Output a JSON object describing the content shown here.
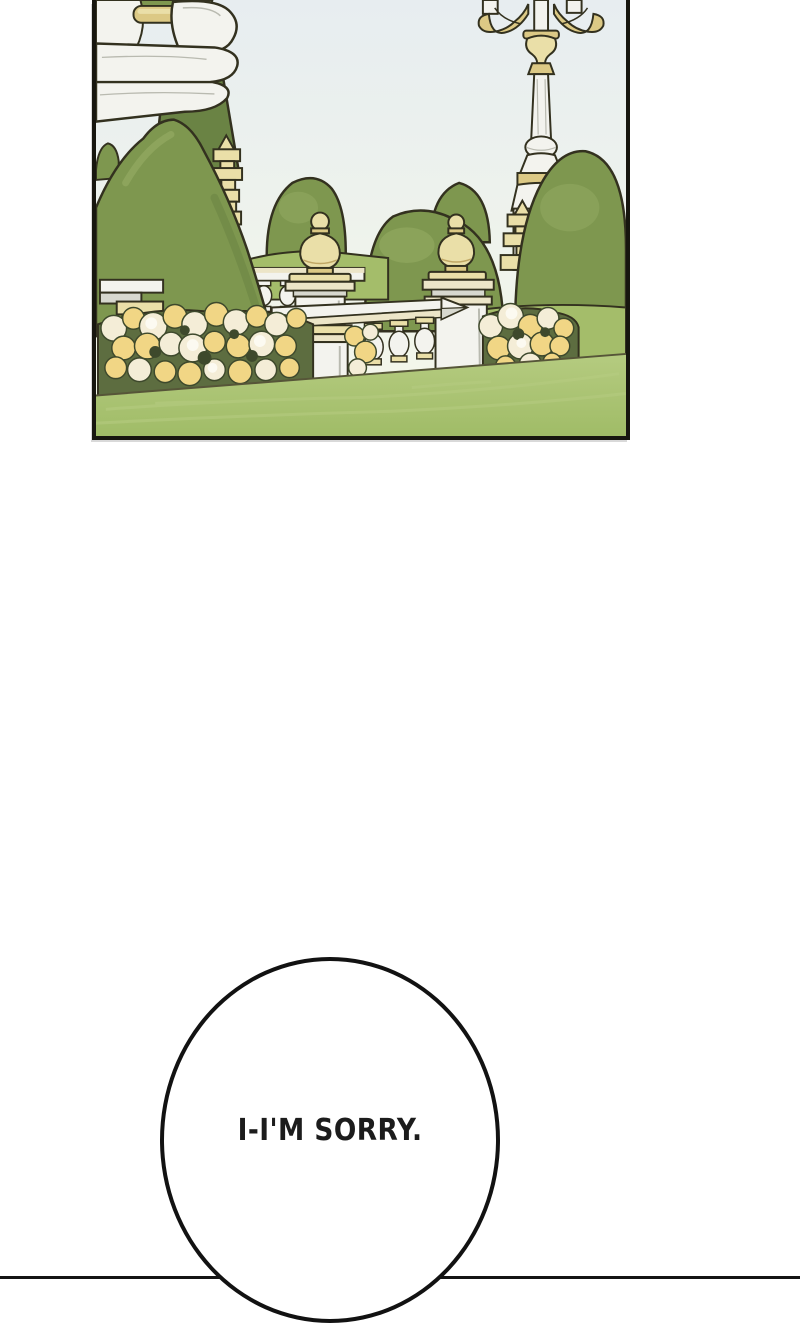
{
  "page": {
    "width_px": 800,
    "height_px": 1280
  },
  "comic_strip": {
    "panel_garden": {
      "description": "Sunlit palace garden: sculpted topiary domes, carved white stone fountain edge at upper left, an ornate candelabra lamppost, a stone balustrade with gold onion finials and pagoda-shaped spires, beds of cream and yellow roses above a mown lawn.",
      "elements": [
        "stone-fountain",
        "ornate-lamppost",
        "topiary-bushes",
        "pagoda-finials",
        "balustrade-with-onion-finials",
        "rose-flower-beds",
        "grass-lawn"
      ]
    },
    "speech_bubble": {
      "text": "I-I'M SORRY."
    },
    "next_panel": {
      "description": "top edge of the following panel"
    }
  },
  "colors": {
    "page_background": "#ffffff",
    "panel_border": "#17160f",
    "outline": "#33311f",
    "sky_top": "#e7edf0",
    "sky_bottom": "#f5f8e9",
    "bush_dark": "#6a8344",
    "bush_mid": "#7e974f",
    "bush_light": "#9cb269",
    "hedge_light": "#a4bd6a",
    "grass_top": "#b5cb80",
    "grass": "#a0bc67",
    "grass_edge": "#565538",
    "stone_white": "#f3f3ee",
    "stone_shade": "#d7d8cf",
    "stone_dark": "#b9bab0",
    "cream": "#ece5c8",
    "gold_light": "#eadfa8",
    "gold_mid": "#dcc985",
    "gold_dark": "#c0a765",
    "flower_cream": "#f4edd7",
    "flower_yellow": "#f1d685",
    "flower_white": "#fcfaf1",
    "leaf": "#5d6d40",
    "leaf_dark": "#3e492c",
    "bubble_fill": "#ffffff",
    "bubble_border": "#121212",
    "bubble_text": "#1c1c1c",
    "divider": "#141414"
  }
}
